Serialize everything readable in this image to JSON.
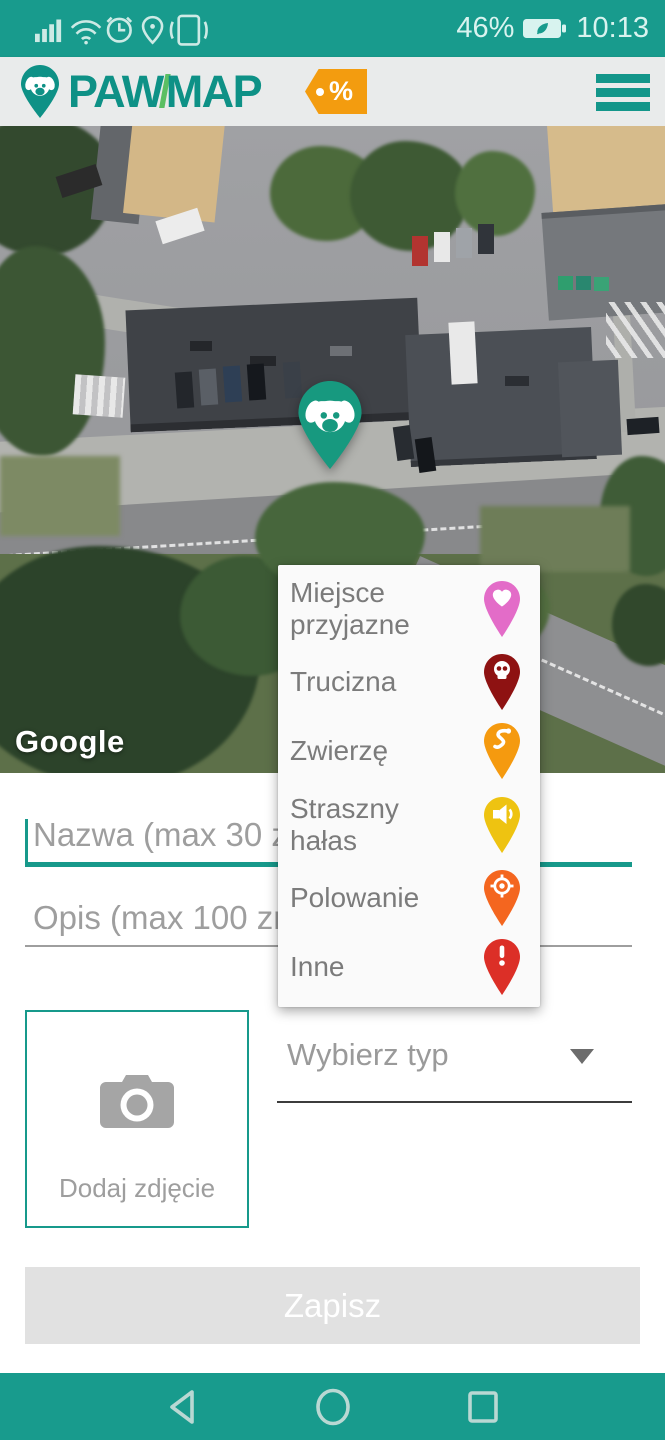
{
  "status_bar": {
    "left_icons": [
      "signal-icon",
      "wifi-icon",
      "alarm-icon",
      "location-icon",
      "vibrate-icon"
    ],
    "battery_percent": "46%",
    "battery_icon": "battery-leaf-icon",
    "time": "10:13"
  },
  "header": {
    "brand_paw": "PAW",
    "brand_slash": "/",
    "brand_map": "MAP",
    "promo_symbol": "%"
  },
  "map": {
    "watermark": "Google",
    "marker": "dog-pin-marker"
  },
  "type_menu": {
    "items": [
      {
        "label": "Miejsce przyjazne",
        "icon": "heart-pin-icon",
        "color": "#e36cc8"
      },
      {
        "label": "Trucizna",
        "icon": "skull-pin-icon",
        "color": "#8e1212"
      },
      {
        "label": "Zwierzę",
        "icon": "snake-pin-icon",
        "color": "#f59a0f"
      },
      {
        "label": "Straszny hałas",
        "icon": "speaker-pin-icon",
        "color": "#eec311"
      },
      {
        "label": "Polowanie",
        "icon": "target-pin-icon",
        "color": "#f4661f"
      },
      {
        "label": "Inne",
        "icon": "exclamation-pin-icon",
        "color": "#dc2f27"
      }
    ]
  },
  "form": {
    "name_placeholder": "Nazwa (max 30 znaków)",
    "description_placeholder": "Opis (max 100 znaków)",
    "add_photo_label": "Dodaj zdjęcie",
    "type_select_label": "Wybierz typ",
    "save_label": "Zapisz"
  },
  "colors": {
    "teal_bar": "#189b8d",
    "logo_teal": "#0e9186",
    "logo_slash_green": "#5bbf63",
    "promo_orange": "#f39c0f",
    "marker_teal": "#17997f",
    "accent_teal": "#17998b",
    "save_button_bg": "#e1e1e1"
  }
}
